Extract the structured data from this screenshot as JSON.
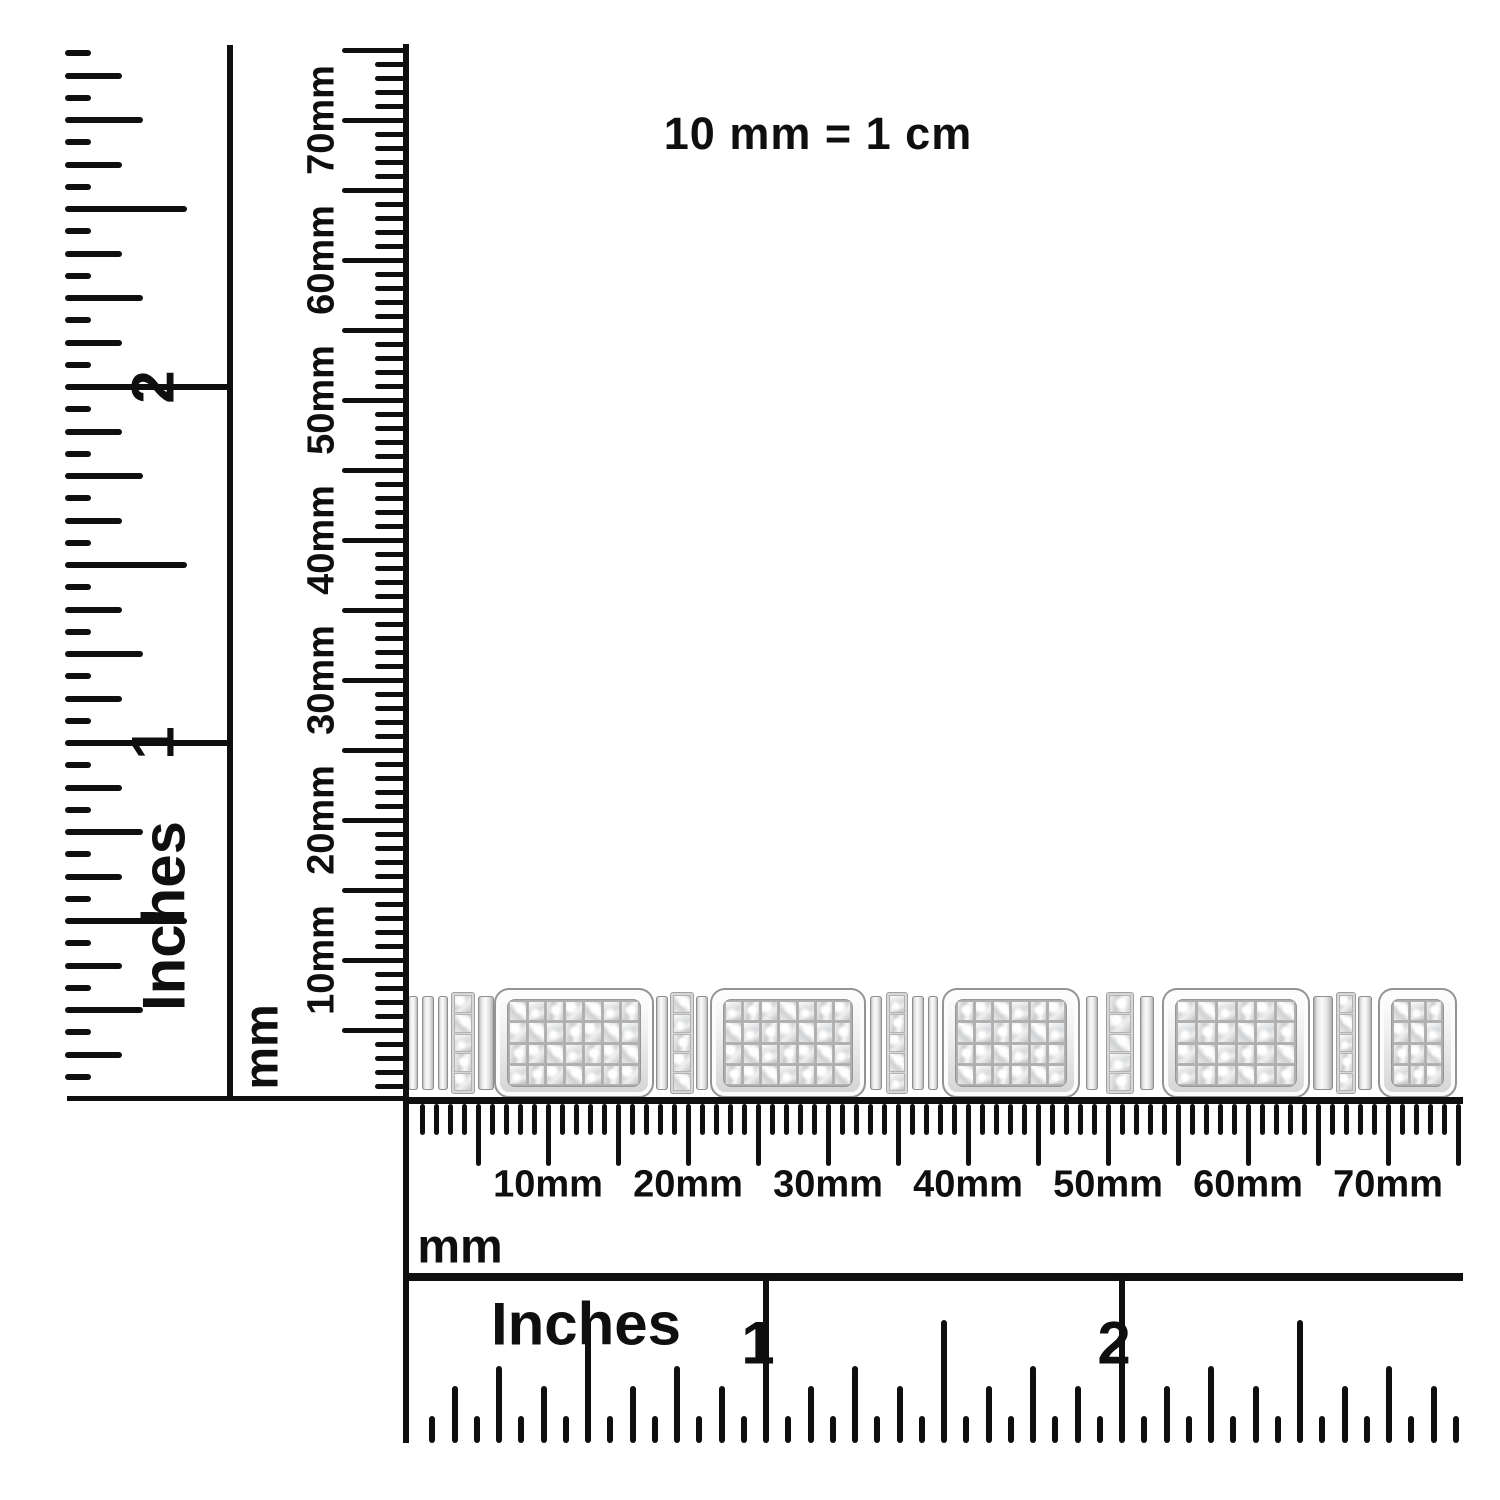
{
  "scale_note": "10 mm = 1 cm",
  "colors": {
    "ink": "#0f0f0f",
    "metal_light": "#fbfbfb",
    "metal_mid": "#d9d9d9",
    "metal_dark": "#9c9c9c"
  },
  "left_inch_ruler": {
    "unit": "Inches",
    "numbers": [
      {
        "label": "1",
        "inch": 1
      },
      {
        "label": "2",
        "inch": 2
      }
    ],
    "sixteenth_ticks": 47
  },
  "left_mm_ruler": {
    "unit": "mm",
    "mm_ticks": 75,
    "labels": [
      {
        "text": "10mm",
        "mm": 10
      },
      {
        "text": "20mm",
        "mm": 20
      },
      {
        "text": "30mm",
        "mm": 30
      },
      {
        "text": "40mm",
        "mm": 40
      },
      {
        "text": "50mm",
        "mm": 50
      },
      {
        "text": "60mm",
        "mm": 60
      },
      {
        "text": "70mm",
        "mm": 70
      }
    ]
  },
  "bottom_mm_ruler": {
    "unit": "mm",
    "mm_ticks": 75,
    "labels": [
      {
        "text": "10mm",
        "mm": 10
      },
      {
        "text": "20mm",
        "mm": 20
      },
      {
        "text": "30mm",
        "mm": 30
      },
      {
        "text": "40mm",
        "mm": 40
      },
      {
        "text": "50mm",
        "mm": 50
      },
      {
        "text": "60mm",
        "mm": 60
      },
      {
        "text": "70mm",
        "mm": 70
      }
    ]
  },
  "bottom_inch_ruler": {
    "unit": "Inches",
    "numbers": [
      {
        "label": "1",
        "inch": 1
      },
      {
        "label": "2",
        "inch": 2
      }
    ],
    "sixteenth_ticks": 47
  },
  "bracelet": {
    "description": "white-metal bracelet with rounded rectangular pave diamond links joined by polished bars and single-column pave connectors",
    "link_stone_rows": 4,
    "connector_stone_rows": 5,
    "segments": [
      {
        "type": "bar",
        "w": 10
      },
      {
        "type": "gap",
        "w": 4
      },
      {
        "type": "bar",
        "w": 12
      },
      {
        "type": "gap",
        "w": 4
      },
      {
        "type": "bar",
        "w": 10
      },
      {
        "type": "gap",
        "w": 3
      },
      {
        "type": "pave",
        "w": 24
      },
      {
        "type": "gap",
        "w": 3
      },
      {
        "type": "bar",
        "w": 16
      },
      {
        "type": "link",
        "w": 160
      },
      {
        "type": "gap",
        "w": 2
      },
      {
        "type": "bar",
        "w": 12
      },
      {
        "type": "gap",
        "w": 2
      },
      {
        "type": "pave",
        "w": 24
      },
      {
        "type": "gap",
        "w": 2
      },
      {
        "type": "bar",
        "w": 12
      },
      {
        "type": "gap",
        "w": 2
      },
      {
        "type": "link",
        "w": 156
      },
      {
        "type": "gap",
        "w": 4
      },
      {
        "type": "bar",
        "w": 12
      },
      {
        "type": "gap",
        "w": 4
      },
      {
        "type": "pave",
        "w": 22
      },
      {
        "type": "gap",
        "w": 4
      },
      {
        "type": "bar",
        "w": 12
      },
      {
        "type": "gap",
        "w": 4
      },
      {
        "type": "bar",
        "w": 10
      },
      {
        "type": "gap",
        "w": 4
      },
      {
        "type": "link",
        "w": 138
      },
      {
        "type": "gap",
        "w": 6
      },
      {
        "type": "bar",
        "w": 12
      },
      {
        "type": "gap",
        "w": 8
      },
      {
        "type": "pave",
        "w": 28
      },
      {
        "type": "gap",
        "w": 6
      },
      {
        "type": "bar",
        "w": 14
      },
      {
        "type": "gap",
        "w": 8
      },
      {
        "type": "link",
        "w": 148
      },
      {
        "type": "gap",
        "w": 3
      },
      {
        "type": "bar",
        "w": 20
      },
      {
        "type": "gap",
        "w": 3
      },
      {
        "type": "pave",
        "w": 20
      },
      {
        "type": "gap",
        "w": 2
      },
      {
        "type": "bar",
        "w": 14
      },
      {
        "type": "gap",
        "w": 6
      },
      {
        "type": "link",
        "w": 79
      }
    ]
  }
}
